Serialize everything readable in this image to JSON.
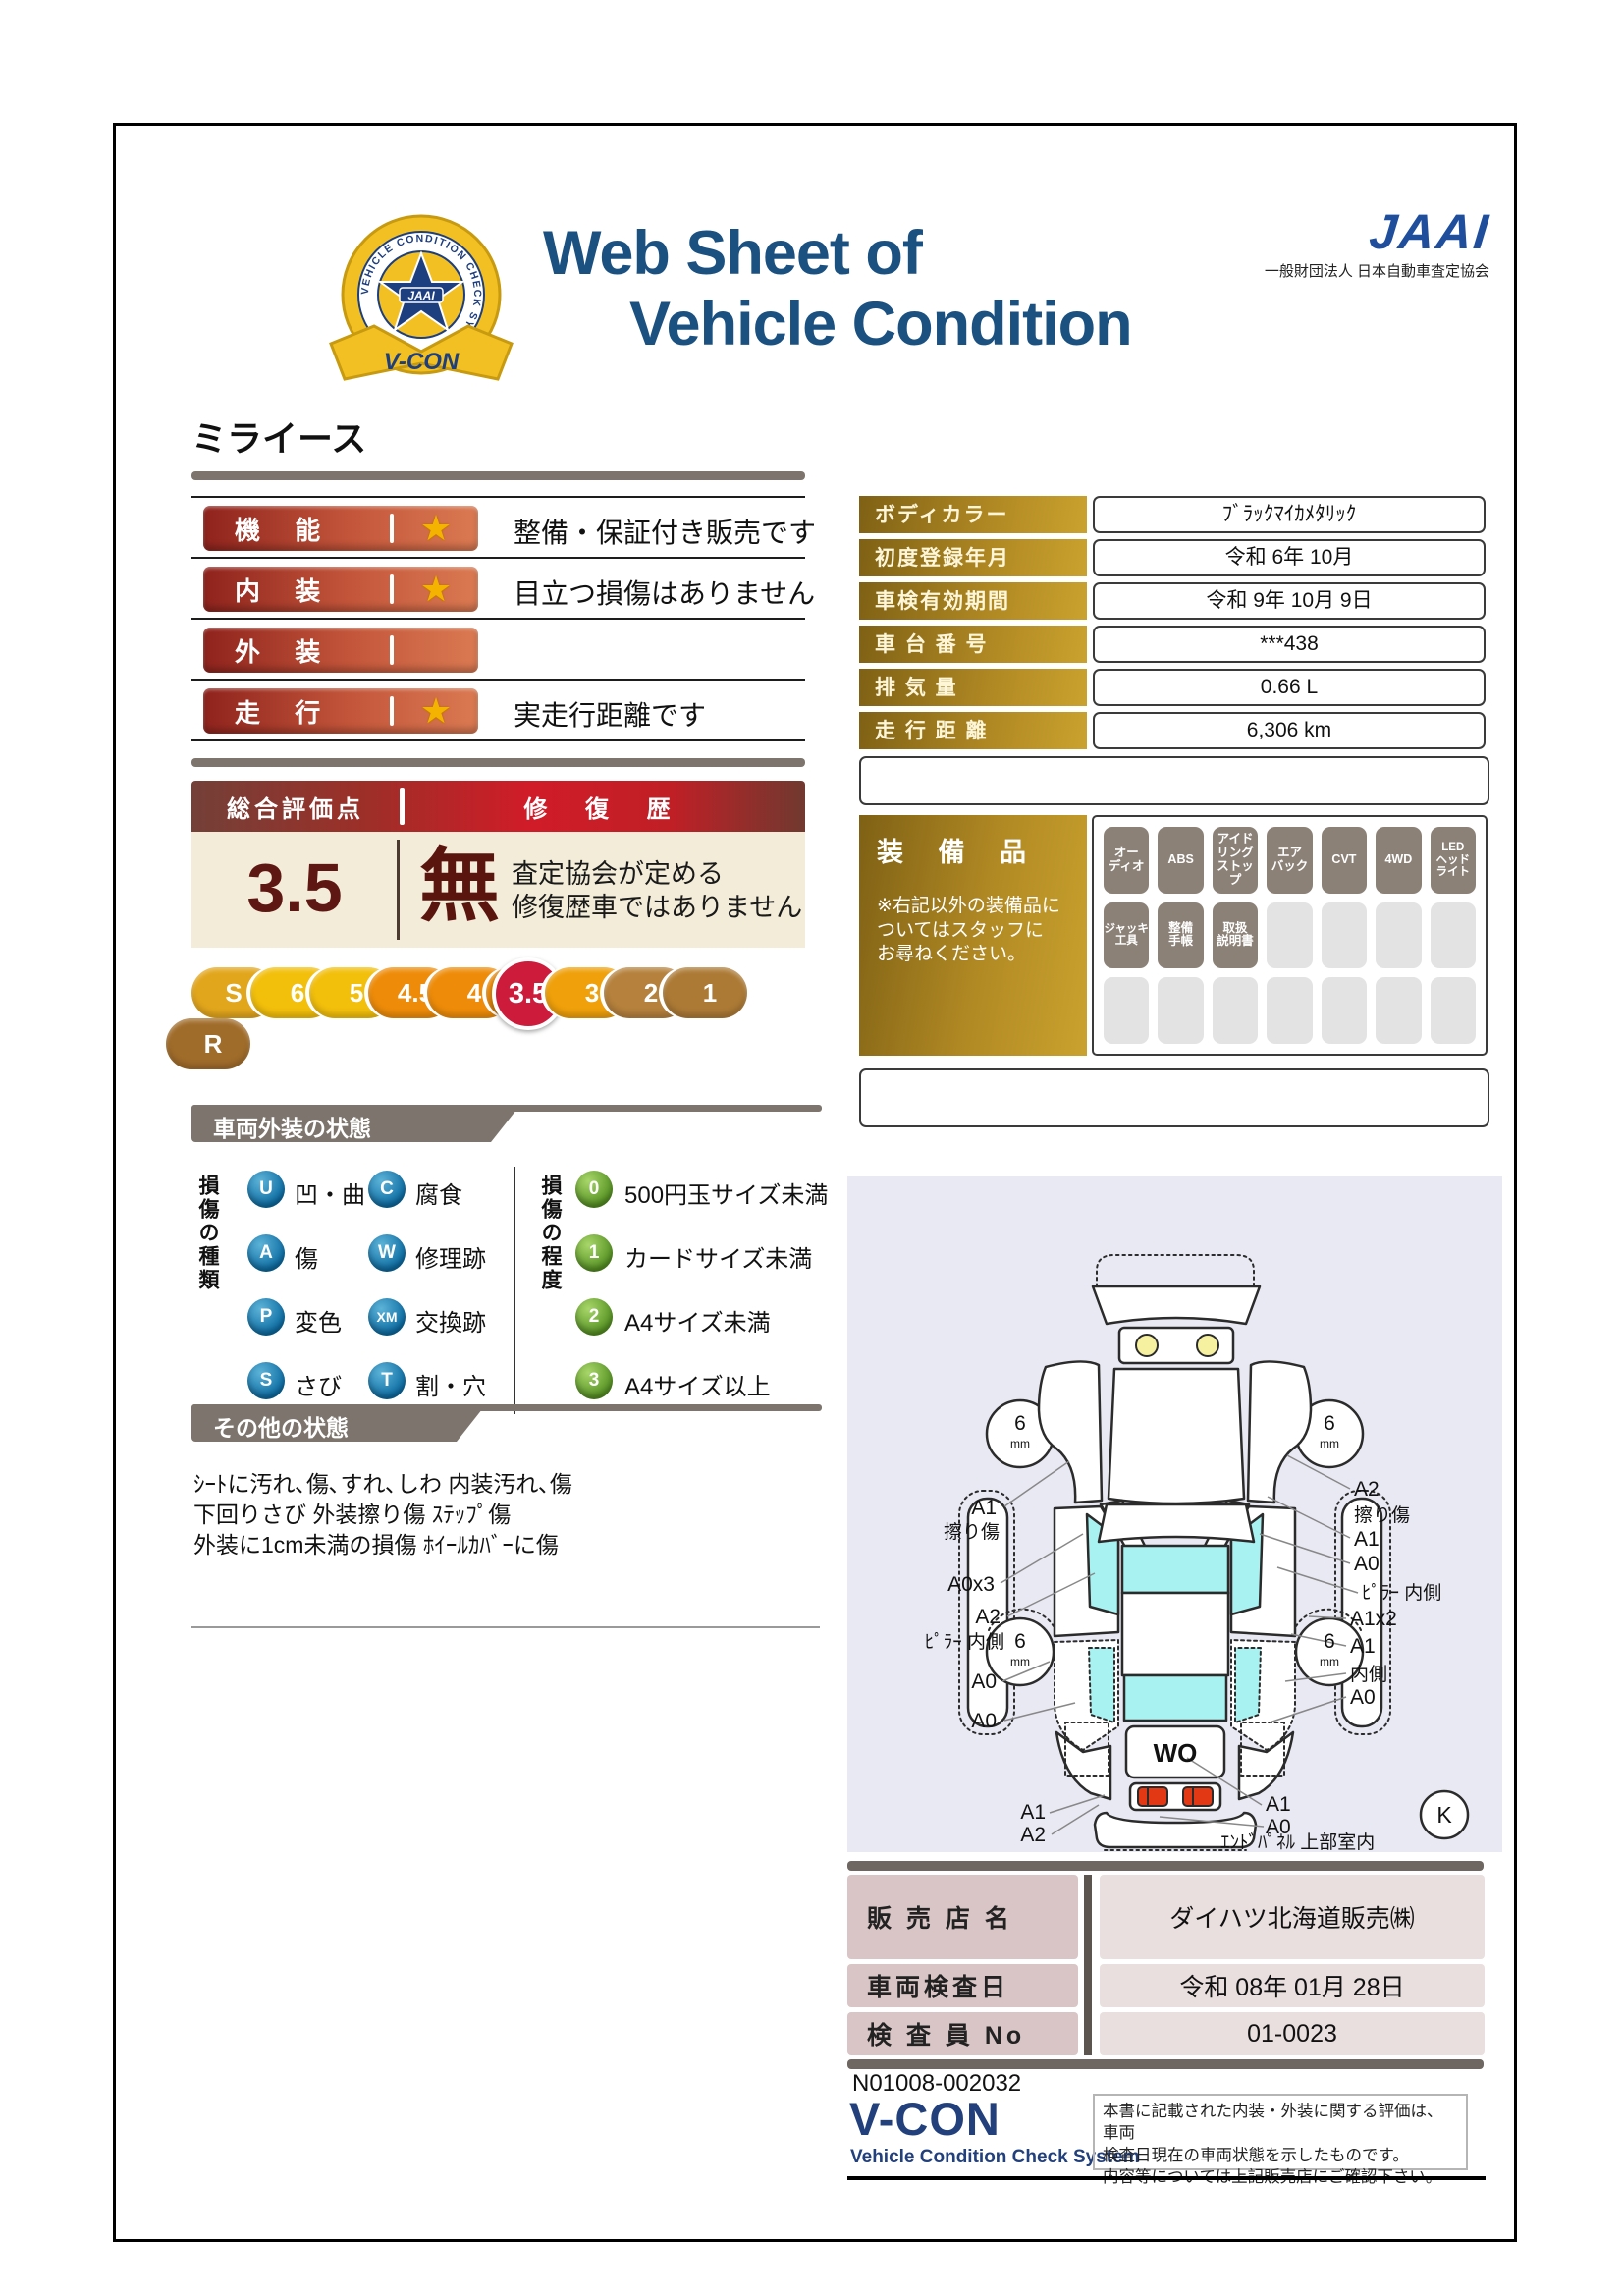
{
  "colors": {
    "title_blue": "#1b5180",
    "jaai_blue": "#1e4e9c",
    "rating_bar_dark": "#8f231d",
    "rating_bar_light": "#da7a52",
    "gold_dark": "#7f6115",
    "gold_light": "#c9a22e",
    "score_maroon": "#5e1712",
    "scale_active_red": "#cd1b3c",
    "section_gray": "#7d756d",
    "equipment_active": "#8b8177",
    "glass_cyan": "#a8f2f2",
    "star_gold": "#f5b301",
    "tail_light_red": "#e23914"
  },
  "header": {
    "badge_ring_text": "VEHICLE CONDITION CHECK SYSTEM",
    "badge_center": "JAAI",
    "badge_ribbon": "V-CON",
    "title_line1": "Web Sheet of",
    "title_line2": "Vehicle Condition",
    "jaai_logo": "JAAI",
    "jaai_subtitle": "一般財団法人 日本自動車査定協会"
  },
  "vehicle_name": "ミライース",
  "ratings": [
    {
      "label": "機 能",
      "star": "★",
      "note": "整備・保証付き販売です"
    },
    {
      "label": "内 装",
      "star": "★",
      "note": "目立つ損傷はありません"
    },
    {
      "label": "外 装",
      "star": "",
      "note": ""
    },
    {
      "label": "走 行",
      "star": "★",
      "note": "実走行距離です"
    }
  ],
  "spec_table": {
    "rows": [
      {
        "label": "ボディカラー",
        "value": "ﾌﾞﾗｯｸﾏｲｶﾒﾀﾘｯｸ"
      },
      {
        "label": "初度登録年月",
        "value": "令和 6年 10月"
      },
      {
        "label": "車検有効期間",
        "value": "令和 9年 10月 9日"
      },
      {
        "label": "車 台 番 号",
        "value": "***438"
      },
      {
        "label": "排 気 量",
        "value": "0.66 L"
      },
      {
        "label": "走 行 距 離",
        "value": "6,306 km"
      }
    ]
  },
  "overall": {
    "header_left": "総合評価点",
    "header_right": "修 復 歴",
    "score": "3.5",
    "repair_status": "無",
    "repair_note_line1": "査定協会が定める",
    "repair_note_line2": "修復歴車ではありません"
  },
  "scale": {
    "active_label": "3.5",
    "items": [
      {
        "label": "S",
        "color": "#e2a61c"
      },
      {
        "label": "6",
        "color": "#f2bf0b"
      },
      {
        "label": "5",
        "color": "#f2bf0b"
      },
      {
        "label": "4.5",
        "color": "#ee8c09"
      },
      {
        "label": "4",
        "color": "#ee8c09"
      },
      {
        "label": "3.5",
        "color": "#ee8c09"
      },
      {
        "label": "3",
        "color": "#efa00a"
      },
      {
        "label": "2",
        "color": "#b5813c"
      },
      {
        "label": "1",
        "color": "#ac7a35"
      },
      {
        "label": "R",
        "color": "#a06c2a"
      }
    ]
  },
  "equipment": {
    "title": "装 備 品",
    "note": "※右記以外の装備品に\nついてはスタッフに\nお尋ねください。",
    "active": [
      "オー\nディオ",
      "ABS",
      "アイド\nリング\nストップ",
      "エア\nバック",
      "CVT",
      "4WD",
      "LED\nヘッド\nライト",
      "ジャッキ\n工具",
      "整備\n手帳",
      "取扱\n説明書"
    ]
  },
  "exterior": {
    "section_title": "車両外装の状態",
    "type_axis": "損傷の種類",
    "degree_axis": "損傷の程度",
    "types": [
      {
        "code": "U",
        "label": "凹・曲"
      },
      {
        "code": "A",
        "label": "傷"
      },
      {
        "code": "P",
        "label": "変色"
      },
      {
        "code": "S",
        "label": "さび"
      },
      {
        "code": "C",
        "label": "腐食"
      },
      {
        "code": "W",
        "label": "修理跡"
      },
      {
        "code": "XM",
        "label": "交換跡"
      },
      {
        "code": "T",
        "label": "割・穴"
      }
    ],
    "degrees": [
      {
        "code": "0",
        "label": "500円玉サイズ未満"
      },
      {
        "code": "1",
        "label": "カードサイズ未満"
      },
      {
        "code": "2",
        "label": "A4サイズ未満"
      },
      {
        "code": "3",
        "label": "A4サイズ以上"
      }
    ]
  },
  "other": {
    "section_title": "その他の状態",
    "lines": "ｼｰﾄに汚れ､傷､すれ､しわ 内装汚れ､傷\n下回りさび 外装擦り傷 ｽﾃｯﾌﾟ傷\n外装に1cm未満の損傷 ﾎｲｰﾙｶﾊﾞｰに傷"
  },
  "diagram": {
    "tread_value": "6",
    "tread_unit": "mm",
    "rear_code": "WO",
    "corner_code": "K",
    "left_labels": [
      "A1",
      "擦り傷",
      "A0x3",
      "A2",
      "ﾋﾟﾗｰ 内側",
      "A0",
      "A0"
    ],
    "right_labels": [
      "A2",
      "擦り傷",
      "A1",
      "A0",
      "ﾋﾟﾗｰ 内側",
      "A1x2",
      "A1",
      "内側",
      "A0"
    ],
    "bottom_left_labels": [
      "A1",
      "A2"
    ],
    "bottom_right_labels": [
      "A1",
      "A0"
    ],
    "bottom_caption": "ｴﾝﾄﾞﾊﾟﾈﾙ 上部室内"
  },
  "dealer": {
    "rows": [
      {
        "label": "販 売 店 名",
        "value": "ダイハツ北海道販売㈱"
      },
      {
        "label": "車両検査日",
        "value": "令和 08年 01月 28日"
      },
      {
        "label": "検 査 員 No",
        "value": "01-0023"
      }
    ]
  },
  "footer": {
    "doc_number": "N01008-002032",
    "vcon_logo": "V-CON",
    "vcon_subtitle": "Vehicle Condition Check System",
    "disclaimer": "本書に記載された内装・外装に関する評価は、車両\n検査日現在の車両状態を示したものです。\n内容等については上記販売店にご確認下さい。"
  }
}
